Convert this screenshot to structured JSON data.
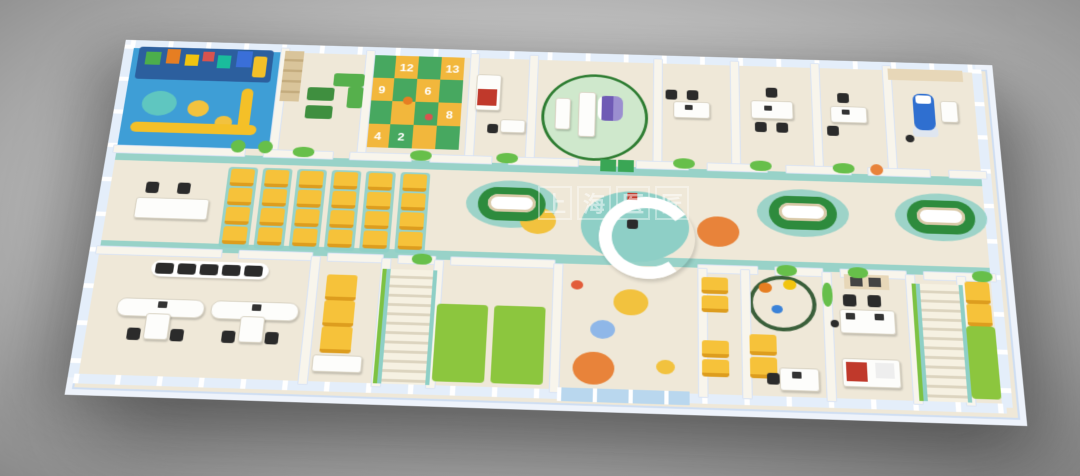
{
  "scene": {
    "type": "3d-floorplan-render",
    "subject": "children's clinic floor - isometric 3D rendering",
    "background": {
      "center_color": "#dadada",
      "edge_color": "#8b8b8b"
    }
  },
  "watermark": {
    "chars": [
      "上",
      "海",
      "医",
      "匠"
    ],
    "color": "#ffffff"
  },
  "hopscotch": {
    "numbers": [
      "12",
      "13",
      "9",
      "6",
      "8",
      "4",
      "2"
    ]
  },
  "palette": {
    "floor_cream": "#efe8d8",
    "wall_white": "#f8f5ec",
    "wall_cap_blue": "#ccdcf4",
    "window_glass": "#e4eefa",
    "teal_path": "#8ecfc6",
    "playground_blue": "#3e9ed6",
    "tile_green": "#47a860",
    "tile_orange": "#f2b73c",
    "chair_yellow": "#f6c23a",
    "bench_green_dark": "#2e8b3d",
    "mat_green": "#8cc63e",
    "sofa_green": "#56b04c",
    "dot_orange": "#e8833a",
    "dot_yellow": "#f2c23e",
    "dot_blue": "#8fb7e8",
    "dot_red": "#e25c3a",
    "machine_purple": "#6f5bb5",
    "blanket_red": "#c0392b",
    "dental_blue": "#2f6fd0",
    "furniture_dark": "#2b2b2b"
  }
}
